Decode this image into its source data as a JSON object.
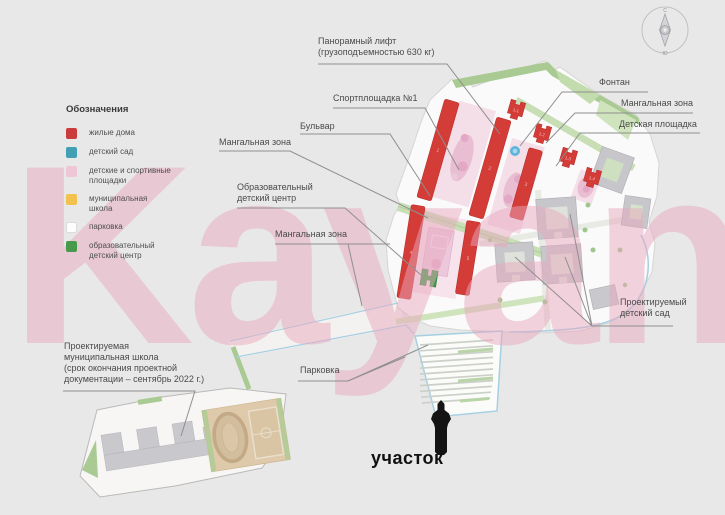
{
  "legend": {
    "title": "Обозначения",
    "items": [
      {
        "label": "жилые дома",
        "color": "#cc3b3b"
      },
      {
        "label": "детский сад",
        "color": "#43a0b4"
      },
      {
        "label": "детские и спортивные\nплощадки",
        "color": "#efc6d6"
      },
      {
        "label": "муниципальная\nшкола",
        "color": "#f2c14e"
      },
      {
        "label": "парковка",
        "color": "#fdfdfd"
      },
      {
        "label": "образовательный\nдетский центр",
        "color": "#479a4b"
      }
    ]
  },
  "callouts": {
    "panoramic_lift": "Панорамный лифт\n(грузоподъемностью 630 кг)",
    "sport_ground": "Спортплощадка №1",
    "boulevard": "Бульвар",
    "mangal_upper": "Мангальная зона",
    "edu_center": "Образовательный\nдетский центр",
    "mangal_lower": "Мангальная зона",
    "fountain": "Фонтан",
    "mangal_right": "Мангальная зона",
    "playground": "Детская площадка",
    "kindergarten": "Проектируемый\nдетский сад",
    "parking": "Парковка",
    "school": "Проектируемая\nмуниципальная школа\n(срок окончания проектной\nдокументации – сентябрь 2022 г.)"
  },
  "site_marker": {
    "label": "участок"
  },
  "compass": {
    "north": "С",
    "south": "Ю"
  },
  "watermark": {
    "text": "Kayan"
  },
  "map": {
    "bars": [
      "1",
      "2",
      "3",
      "4",
      "5"
    ],
    "towers": [
      "1.1",
      "1.2",
      "1.3",
      "1.4"
    ]
  },
  "colors": {
    "background": "#e9e8e9",
    "building_red": "#d43c38",
    "playground_pink": "#e9bdd2",
    "green_area": "#c8dfb6",
    "water_blue": "#a6cfe3",
    "leader_line": "#8f8f8f",
    "watermark_pink": "#eeaabf"
  }
}
